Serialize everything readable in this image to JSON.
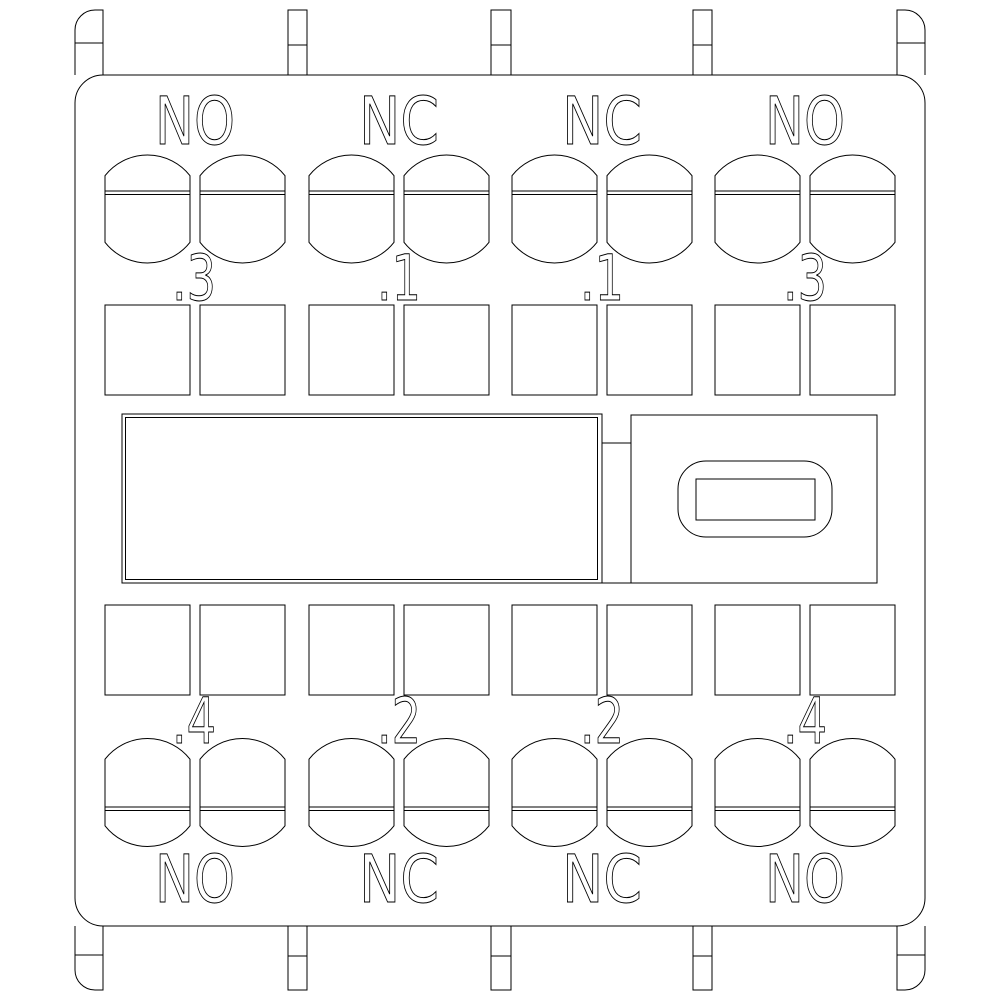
{
  "drawing": {
    "background_color": "#ffffff",
    "line_color": "#000000",
    "poles": [
      {
        "contact_type_top": "NO",
        "terminal_top": ".3",
        "terminal_bottom": ".4",
        "contact_type_bottom": "NO"
      },
      {
        "contact_type_top": "NC",
        "terminal_top": ".1",
        "terminal_bottom": ".2",
        "contact_type_bottom": "NC"
      },
      {
        "contact_type_top": "NC",
        "terminal_top": ".1",
        "terminal_bottom": ".2",
        "contact_type_bottom": "NC"
      },
      {
        "contact_type_top": "NO",
        "terminal_top": ".3",
        "terminal_bottom": ".4",
        "contact_type_bottom": "NO"
      }
    ]
  }
}
